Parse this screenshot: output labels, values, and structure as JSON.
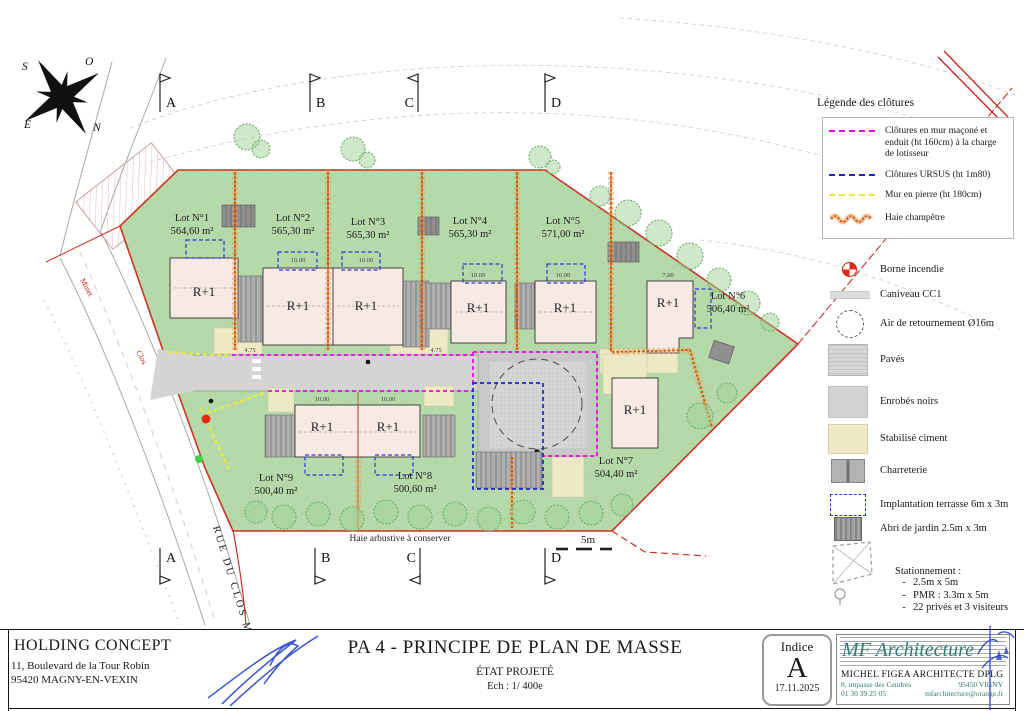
{
  "page": {
    "title": "PA 4 - PRINCIPE DE PLAN DE MASSE",
    "subtitle": "ÉTAT PROJETÉ",
    "scale": "Ech : 1/ 400e"
  },
  "client": {
    "name": "HOLDING CONCEPT",
    "address1": "11, Boulevard de la Tour Robin",
    "address2": "95420 MAGNY-EN-VEXIN"
  },
  "indice": {
    "label": "Indice",
    "value": "A",
    "date": "17.11.2025"
  },
  "architect": {
    "logo": "MF Architecture",
    "name": "MICHEL FIGEA ARCHITECTE DPLG",
    "address": "8, impasse des Cendres",
    "city": "95450 VIGNY",
    "phone": "01 30 39 25 05",
    "email": "mfarchitecture@orange.fr"
  },
  "compass": {
    "n": "N",
    "s": "S",
    "e": "E",
    "o": "O"
  },
  "sections": [
    "A",
    "B",
    "C",
    "D"
  ],
  "fence_legend": {
    "title": "Légende des clôtures",
    "items": [
      {
        "label": "Clôtures en mur maçoné et enduit (ht 160cm) à la charge de lotisseur",
        "color": "#f000f0"
      },
      {
        "label": "Clôtures URSUS (ht 1m80)",
        "color": "#2222cc"
      },
      {
        "label": "Mur en pierre  (ht 180cm)",
        "color": "#e9e93e"
      },
      {
        "label": "Haie champêtre",
        "color": "#e07820"
      }
    ]
  },
  "symbol_legend": {
    "items": [
      {
        "label": "Borne incendie",
        "icon": "hydrant-icon"
      },
      {
        "label": "Caniveau CC1",
        "icon": "gutter-icon"
      },
      {
        "label": "Air de retournement Ø16m",
        "icon": "turning-circle-icon"
      },
      {
        "label": "Pavés",
        "icon": "pavers-swatch"
      },
      {
        "label": "Enrobés noirs",
        "icon": "asphalt-swatch"
      },
      {
        "label": "Stabilisé ciment",
        "icon": "cement-swatch"
      },
      {
        "label": "Charreterie",
        "icon": "cartshed-swatch"
      },
      {
        "label": "Implantation terrasse 6m x 3m",
        "icon": "terrace-outline-icon"
      },
      {
        "label": "Abri de jardin 2.5m x 3m",
        "icon": "garden-shed-swatch"
      }
    ],
    "parking": {
      "title": "Stationnement :",
      "marker": "-",
      "bullets": [
        "2.5m x 5m",
        "PMR : 3.3m x 5m",
        "22 privés et 3 visiteurs"
      ]
    }
  },
  "lots": [
    {
      "name": "Lot N°1",
      "area": "564,60 m²"
    },
    {
      "name": "Lot N°2",
      "area": "565,30 m²"
    },
    {
      "name": "Lot N°3",
      "area": "565,30 m²"
    },
    {
      "name": "Lot N°4",
      "area": "565,30 m²"
    },
    {
      "name": "Lot N°5",
      "area": "571,00 m²"
    },
    {
      "name": "Lot N°6",
      "area": "506,40 m²"
    },
    {
      "name": "Lot N°7",
      "area": "504,40 m²"
    },
    {
      "name": "Lot N°8",
      "area": "500,60 m²"
    },
    {
      "name": "Lot N°9",
      "area": "500,40 m²"
    }
  ],
  "map": {
    "building_label": "R+1",
    "street": "RUE DU CLOS MINET",
    "street_red_1": "Minet",
    "street_red_2": "Clos",
    "hedge_note": "Haie arbustive à conserver",
    "scale_marker": "5m",
    "dims": [
      "10.00",
      "10.00",
      "10.00",
      "10.00",
      "10.00",
      "10.00",
      "4.75",
      "4.75",
      "7.00"
    ]
  },
  "colors": {
    "site_green": "#b5d9a8",
    "boundary_red": "#cc3322",
    "fence_magenta": "#f000f0",
    "fence_blue": "#2222cc",
    "fence_yellow": "#e9e93e",
    "hedge_orange": "#d35400",
    "road_gray": "#d4d4d4",
    "stabilise": "#ece9c4",
    "architect_teal": "#2e7d72"
  }
}
